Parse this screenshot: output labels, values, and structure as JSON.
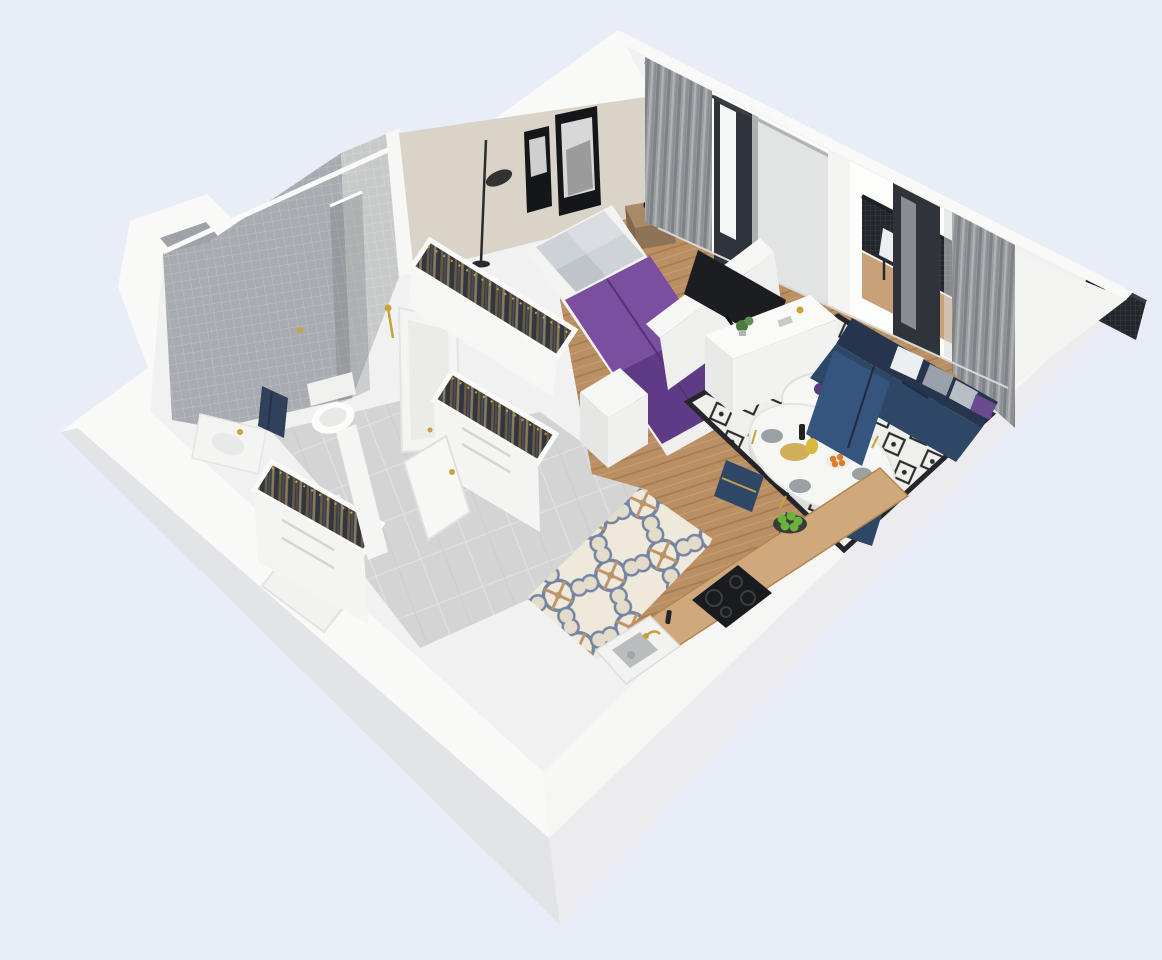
{
  "scene": {
    "kind": "3d-floorplan-cutaway-render",
    "view": "isometric top-down cutaway of a one-bedroom apartment",
    "rooms": [
      {
        "name": "bathroom",
        "items": [
          "bathtub",
          "wall-hung-toilet",
          "vanity-sink",
          "navy-towel",
          "gold-shower-set",
          "shower-glass",
          "utility-shaft"
        ]
      },
      {
        "name": "hallway",
        "items": [
          "open-wardrobe-with-clothes",
          "open-wardrobe-2",
          "white-door",
          "entrance-door",
          "large-gray-floor-tiles"
        ]
      },
      {
        "name": "bedroom",
        "items": [
          "double-bed-purple-duvet",
          "gray-pillows",
          "wood-nightstand",
          "alarm-clock",
          "black-floor-lamp",
          "two-framed-artworks",
          "open-wardrobe-run",
          "white-dresser",
          "curtained-window"
        ]
      },
      {
        "name": "living-room",
        "items": [
          "navy-corner-sofa",
          "throw-pillows",
          "round-coffee-table",
          "purple-vase",
          "oval-dining-table",
          "navy-dining-chairs",
          "gold-cutlery",
          "fruit-and-plates",
          "diamond-pattern-rug",
          "tv-on-white-sideboard",
          "herringbone-wood-floor"
        ]
      },
      {
        "name": "kitchen",
        "items": [
          "wood-countertop",
          "induction-cooktop",
          "kitchen-sink",
          "gold-faucet",
          "plate-of-green-apples",
          "ornate-patterned-tiles"
        ]
      },
      {
        "name": "balcony",
        "items": [
          "black-mesh-railing",
          "outdoor-chair-white-cushion",
          "wood-deck",
          "sheer-and-gray-curtains"
        ]
      }
    ]
  },
  "palette": {
    "background": "#e9edf8",
    "wallWhite": "#f9f9f8",
    "wallFaceLeft": "#e2e4e8",
    "wallFaceRight": "#ececef",
    "tileDark": "#a8acb1",
    "tileLight": "#c8cac9",
    "bigTile": "#d3d4d3",
    "ornateBg": "#efe9dc",
    "ornateBlue": "#7585a1",
    "ornateTan": "#bd9468",
    "wood": "#b98f63",
    "counterWood": "#cfa87c",
    "beigeWall": "#d9d3c8",
    "windowGlow": "#fdfdfc",
    "frameDark": "#2f343a",
    "curtain": "#989ba0",
    "sheer": "#d8dadb",
    "railing": "#23262b",
    "deck": "#c9a178",
    "sofa": "#2e4766",
    "sofaBack": "#26344d",
    "chaise": "#35547e",
    "duvet": "#7b4fa0",
    "duvetDark": "#5f3a85",
    "pillowGray": "#cdd2d6",
    "rugBase": "#efefec",
    "rugInk": "#2b2b2b",
    "furnitureWhite": "#f4f4f2",
    "gold": "#c9a23f",
    "towel": "#31415a",
    "cooktop": "#1a1b1e",
    "apple": "#68b33c",
    "orange": "#e07b28",
    "plant": "#4c7a3f",
    "vase": "#5d3b82",
    "tv": "#1b1d20",
    "nightstand": "#a98a68"
  }
}
